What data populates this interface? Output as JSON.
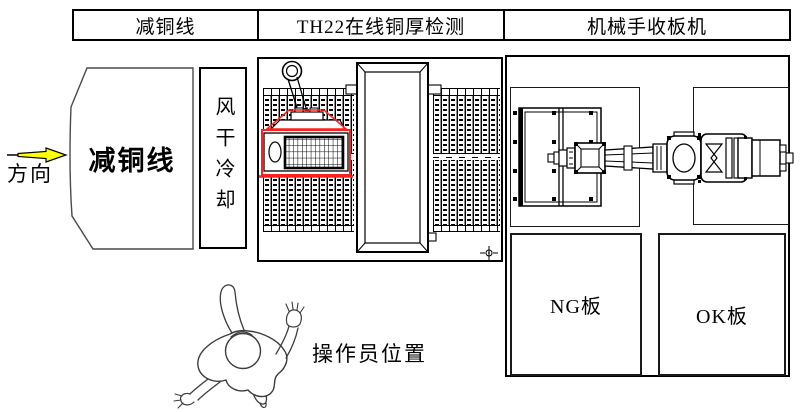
{
  "canvas": {
    "width": 800,
    "height": 412
  },
  "colors": {
    "outline": "#000000",
    "highlight_red": "#ff1f1f",
    "arrow_yellow": "#ffff00",
    "sketch": "#3c3c3c"
  },
  "header": {
    "cells": [
      "减铜线",
      "TH22在线铜厚检测",
      "机械手收板机"
    ]
  },
  "flow": {
    "direction_label": "方向"
  },
  "copper_line": {
    "label": "减铜线"
  },
  "cooling": {
    "label": "风干冷却"
  },
  "unload": {
    "ng_label": "NG板",
    "ok_label": "OK板"
  },
  "operator": {
    "label": "操作员位置"
  }
}
